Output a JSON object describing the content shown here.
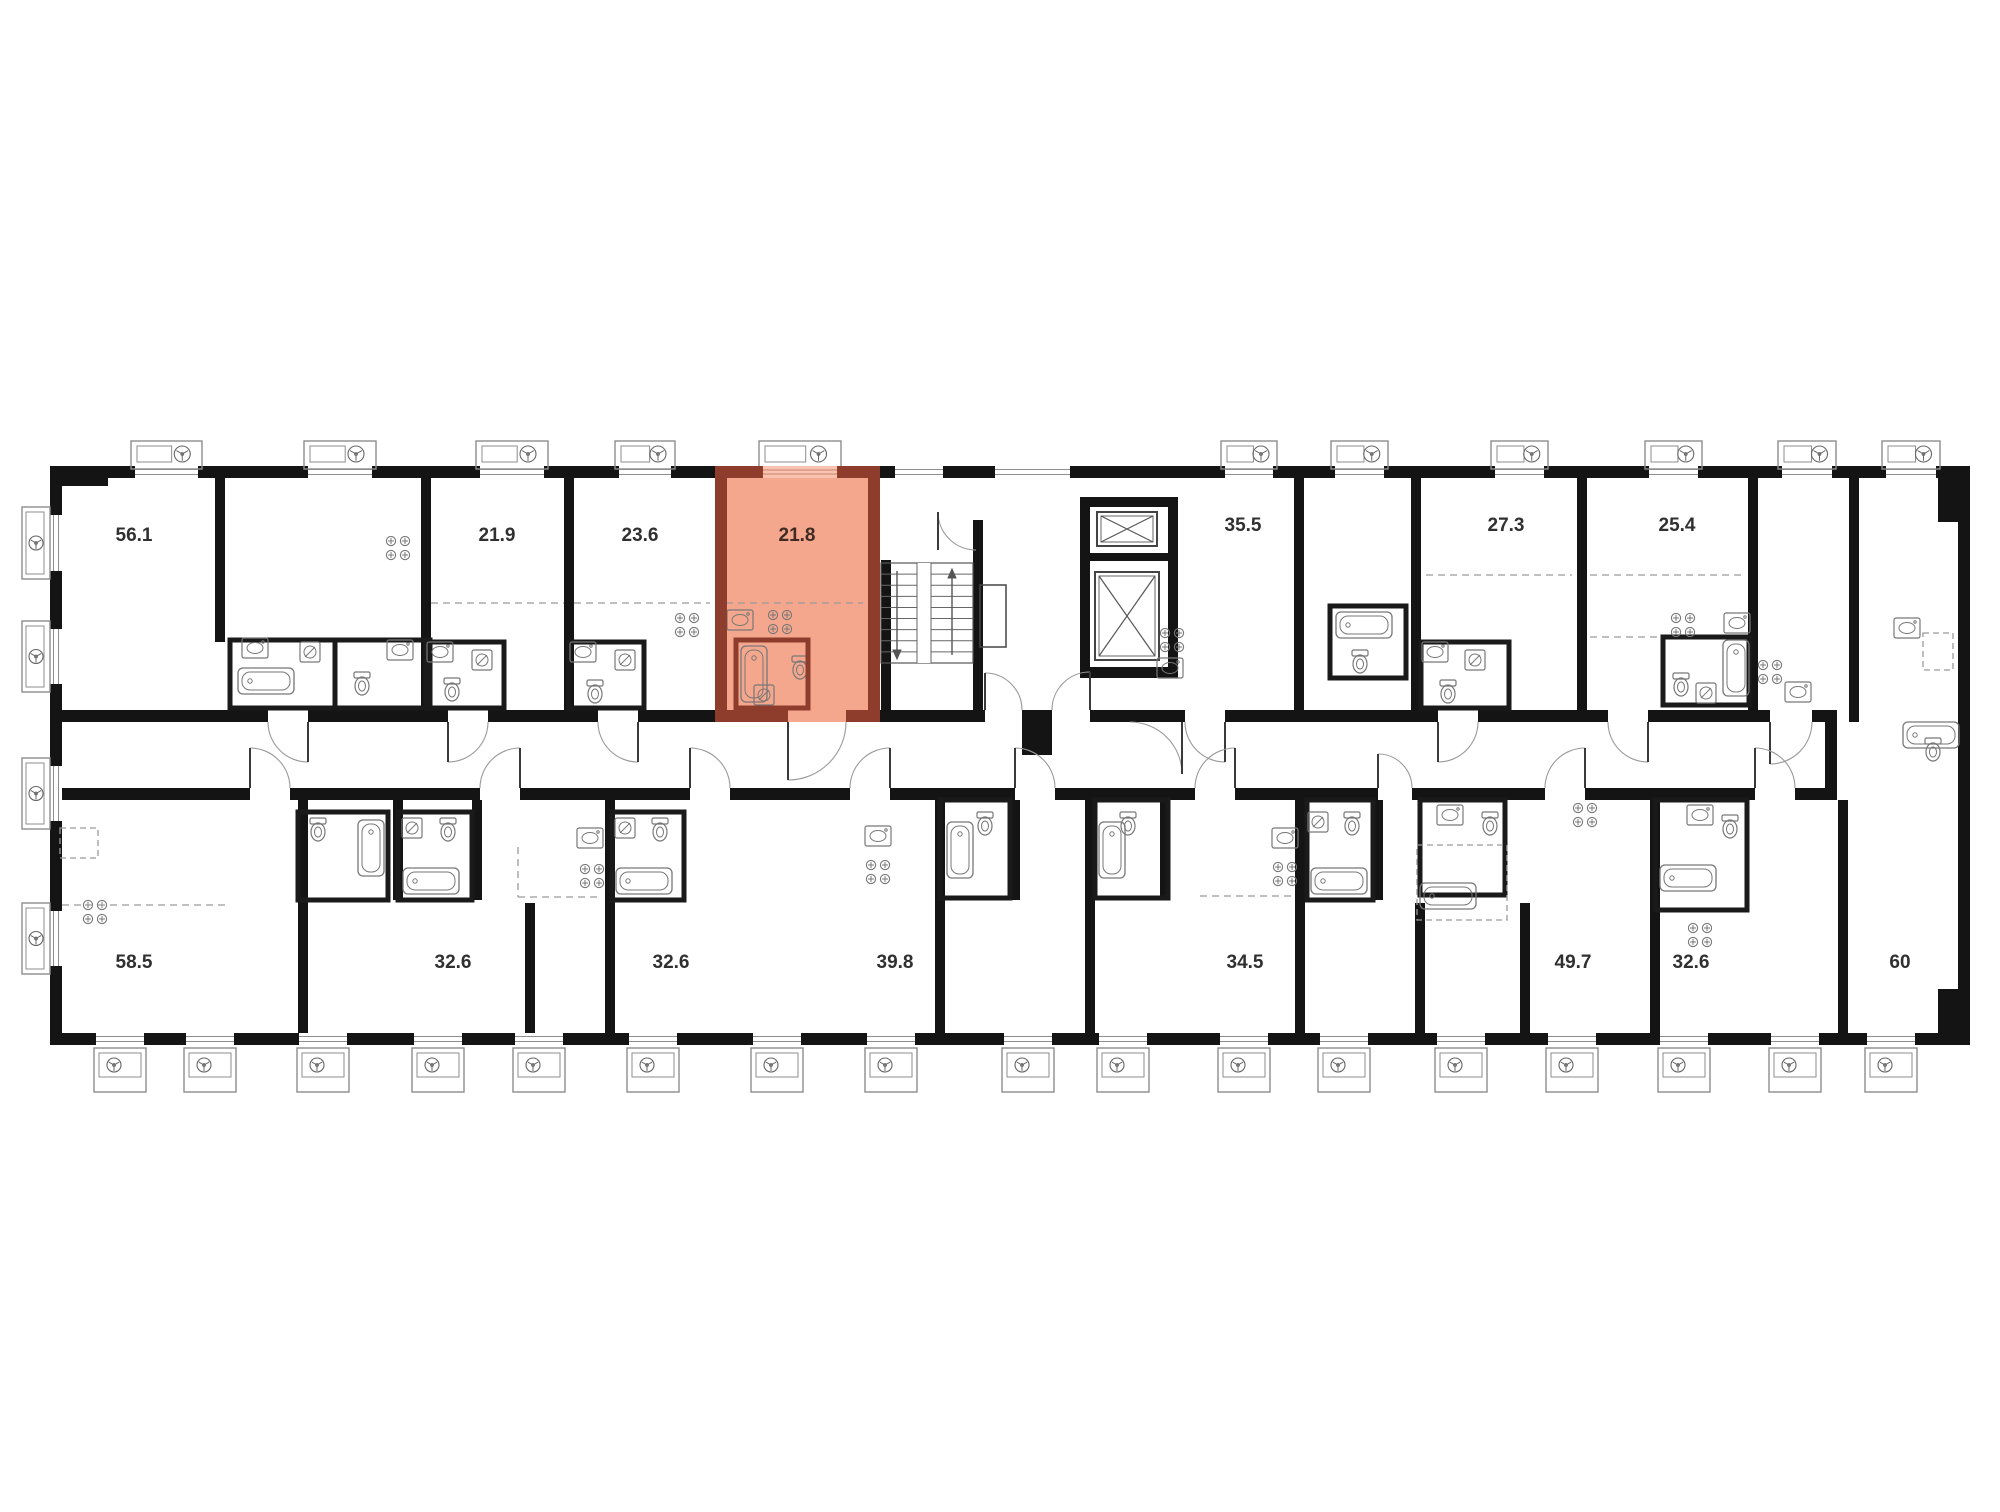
{
  "plan": {
    "type": "residential-floor-plan",
    "highlighted_unit": {
      "area": "21.8",
      "fill": "#f5a78e",
      "wall": "#8e3c2b",
      "window": "#f9c3b2"
    },
    "colors": {
      "wall": "#141414",
      "thin": "#1f1f1f",
      "fixture": "#777777",
      "dash": "#9a9a9a",
      "door_arc": "#9a9a9a",
      "door_leaf": "#3a3a3a",
      "balcony": "#8d8d8d",
      "window_line": "#8d8d8d",
      "label": "#303030",
      "highlight_label": "#3f2b23"
    },
    "labels": [
      {
        "text": "56.1",
        "x": 134,
        "y": 541
      },
      {
        "text": "21.9",
        "x": 497,
        "y": 541
      },
      {
        "text": "23.6",
        "x": 640,
        "y": 541
      },
      {
        "text": "21.8",
        "x": 797,
        "y": 541,
        "hl": true
      },
      {
        "text": "35.5",
        "x": 1243,
        "y": 531
      },
      {
        "text": "27.3",
        "x": 1506,
        "y": 531
      },
      {
        "text": "25.4",
        "x": 1677,
        "y": 531
      },
      {
        "text": "58.5",
        "x": 134,
        "y": 968
      },
      {
        "text": "32.6",
        "x": 453,
        "y": 968
      },
      {
        "text": "32.6",
        "x": 671,
        "y": 968
      },
      {
        "text": "39.8",
        "x": 895,
        "y": 968
      },
      {
        "text": "34.5",
        "x": 1245,
        "y": 968
      },
      {
        "text": "49.7",
        "x": 1573,
        "y": 968
      },
      {
        "text": "32.6",
        "x": 1691,
        "y": 968
      },
      {
        "text": "60",
        "x": 1900,
        "y": 968
      }
    ],
    "geometry": {
      "canvas": [
        2000,
        1512
      ],
      "outer": {
        "top": [
          50,
          466,
          1920,
          12
        ],
        "bottom": [
          50,
          1033,
          1920,
          12
        ],
        "left": [
          50,
          466,
          12,
          579
        ],
        "right": [
          1958,
          466,
          12,
          579
        ],
        "pillars": [
          [
            1938,
            466,
            32,
            56
          ],
          [
            1938,
            989,
            32,
            56
          ],
          [
            50,
            466,
            58,
            20
          ]
        ]
      },
      "band_top": {
        "y": 710,
        "h": 12,
        "x0": 50,
        "x1": 1825,
        "gaps": [
          [
            268,
            308
          ],
          [
            448,
            488
          ],
          [
            598,
            638
          ],
          [
            788,
            846
          ],
          [
            985,
            1022
          ],
          [
            1052,
            1090
          ],
          [
            1185,
            1225
          ],
          [
            1438,
            1478
          ],
          [
            1608,
            1648
          ],
          [
            1770,
            1812
          ]
        ]
      },
      "band_bottom": {
        "y": 788,
        "h": 12,
        "x0": 50,
        "x1": 1825,
        "gaps": [
          [
            250,
            290
          ],
          [
            480,
            520
          ],
          [
            690,
            730
          ],
          [
            850,
            890
          ],
          [
            1015,
            1055
          ],
          [
            1195,
            1235
          ],
          [
            1378,
            1412
          ],
          [
            1545,
            1585
          ],
          [
            1755,
            1795
          ]
        ]
      },
      "corridor_end_wall": [
        1825,
        710,
        12,
        90
      ],
      "lobby_post": [
        1022,
        710,
        30,
        45
      ],
      "vwalls": [
        [
          215,
          466,
          10,
          176
        ],
        [
          421,
          466,
          10,
          256
        ],
        [
          564,
          466,
          10,
          256
        ],
        [
          881,
          560,
          10,
          162
        ],
        [
          973,
          520,
          10,
          202
        ],
        [
          1294,
          466,
          10,
          256
        ],
        [
          1411,
          466,
          10,
          256
        ],
        [
          1577,
          466,
          10,
          256
        ],
        [
          1748,
          466,
          10,
          256
        ],
        [
          1849,
          466,
          10,
          256
        ],
        [
          298,
          800,
          10,
          233
        ],
        [
          605,
          800,
          10,
          233
        ],
        [
          935,
          800,
          10,
          233
        ],
        [
          1085,
          800,
          10,
          233
        ],
        [
          1295,
          800,
          10,
          233
        ],
        [
          1650,
          800,
          10,
          233
        ],
        [
          1838,
          800,
          10,
          233
        ],
        [
          393,
          800,
          10,
          100
        ],
        [
          472,
          800,
          10,
          100
        ],
        [
          1010,
          800,
          10,
          100
        ],
        [
          1160,
          800,
          10,
          100
        ],
        [
          1373,
          800,
          10,
          100
        ],
        [
          525,
          903,
          10,
          130
        ],
        [
          1415,
          903,
          10,
          130
        ],
        [
          1520,
          903,
          10,
          130
        ]
      ],
      "balconies_top": [
        [
          135,
          63
        ],
        [
          308,
          64
        ],
        [
          480,
          64
        ],
        [
          619,
          52
        ],
        [
          763,
          74
        ],
        [
          1225,
          48
        ],
        [
          1335,
          49
        ],
        [
          1495,
          49
        ],
        [
          1649,
          49
        ],
        [
          1782,
          50
        ],
        [
          1886,
          50
        ]
      ],
      "windows_top_extra": [
        [
          895,
          48
        ],
        [
          995,
          75
        ]
      ],
      "balconies_bottom_cx": [
        120,
        210,
        323,
        438,
        539,
        653,
        777,
        891,
        1028,
        1123,
        1244,
        1344,
        1461,
        1572,
        1684,
        1795,
        1891
      ],
      "balconies_left": [
        [
          507,
          72
        ],
        [
          621,
          71
        ],
        [
          758,
          71
        ],
        [
          903,
          71
        ]
      ],
      "stairs": {
        "x": 881,
        "y": 563,
        "w": 92,
        "h": 100,
        "treads": 9,
        "gap": [
          917,
          931
        ],
        "duct": [
          980,
          585,
          26,
          62
        ]
      },
      "elevators": {
        "frame": [
          [
            1080,
            497,
            10,
            180
          ],
          [
            1168,
            497,
            10,
            180
          ],
          [
            1080,
            497,
            98,
            10
          ],
          [
            1080,
            667,
            98,
            11
          ],
          [
            1080,
            553,
            98,
            8
          ]
        ],
        "cabs": [
          [
            1097,
            512,
            60,
            34
          ],
          [
            1095,
            572,
            64,
            88
          ]
        ]
      },
      "red_unit": {
        "x": 715,
        "x2": 880,
        "y": 466,
        "y2": 722,
        "t": 12,
        "window": [
          763,
          74
        ],
        "door": [
          788,
          846
        ],
        "bath": [
          736,
          640,
          72,
          68
        ]
      },
      "bath_blocks": [
        [
          230,
          640,
          105,
          68
        ],
        [
          335,
          640,
          95,
          68
        ],
        [
          426,
          642,
          78,
          66
        ],
        [
          569,
          642,
          75,
          66
        ],
        [
          1330,
          606,
          76,
          72
        ],
        [
          1421,
          642,
          88,
          66
        ],
        [
          1663,
          637,
          86,
          68
        ],
        [
          298,
          812,
          90,
          88
        ],
        [
          398,
          812,
          74,
          88
        ],
        [
          612,
          812,
          72,
          88
        ],
        [
          940,
          800,
          70,
          98
        ],
        [
          1095,
          800,
          73,
          98
        ],
        [
          1307,
          800,
          66,
          100
        ],
        [
          1420,
          800,
          85,
          95
        ],
        [
          1655,
          800,
          92,
          110
        ]
      ],
      "doors_top": [
        [
          268,
          308,
          "dnR"
        ],
        [
          448,
          488,
          "dnL"
        ],
        [
          598,
          638,
          "dnR"
        ],
        [
          788,
          846,
          "dnL"
        ],
        [
          985,
          1022,
          "upL"
        ],
        [
          1052,
          1090,
          "upR"
        ],
        [
          1185,
          1225,
          "dnR"
        ],
        [
          1438,
          1478,
          "dnL"
        ],
        [
          1608,
          1648,
          "dnR"
        ],
        [
          1770,
          1812,
          "dnL"
        ]
      ],
      "doors_bottom": [
        [
          250,
          290,
          "uL"
        ],
        [
          480,
          520,
          "uR"
        ],
        [
          690,
          730,
          "uL"
        ],
        [
          850,
          890,
          "uR"
        ],
        [
          1015,
          1055,
          "uL"
        ],
        [
          1195,
          1235,
          "uR"
        ],
        [
          1378,
          1412,
          "uL"
        ],
        [
          1545,
          1585,
          "uR"
        ],
        [
          1755,
          1795,
          "uL"
        ]
      ],
      "extra_arcs": [
        {
          "d": "M 938 512 A 38 38 0 0 0 976 550",
          "leaf": [
            938,
            512,
            938,
            550
          ]
        },
        {
          "d": "M 1130 722 A 52 52 0 0 1 1182 774",
          "leaf": [
            1182,
            722,
            1182,
            774
          ]
        }
      ],
      "stoves": [
        [
          398,
          548
        ],
        [
          687,
          625
        ],
        [
          780,
          622
        ],
        [
          1172,
          640
        ],
        [
          1683,
          625
        ],
        [
          1770,
          672
        ],
        [
          95,
          912
        ],
        [
          592,
          876
        ],
        [
          878,
          872
        ],
        [
          1285,
          874
        ],
        [
          1585,
          815
        ],
        [
          1700,
          935
        ]
      ],
      "sinks": [
        [
          255,
          648
        ],
        [
          400,
          650
        ],
        [
          440,
          652
        ],
        [
          583,
          652
        ],
        [
          740,
          620
        ],
        [
          1170,
          668
        ],
        [
          1435,
          652
        ],
        [
          1737,
          623
        ],
        [
          1798,
          692
        ],
        [
          1907,
          628
        ],
        [
          590,
          838
        ],
        [
          878,
          836
        ],
        [
          1285,
          838
        ],
        [
          1450,
          815
        ],
        [
          1700,
          815
        ]
      ],
      "toilets": [
        [
          362,
          682
        ],
        [
          452,
          688
        ],
        [
          595,
          690
        ],
        [
          800,
          666
        ],
        [
          1360,
          660
        ],
        [
          1448,
          690
        ],
        [
          1681,
          683
        ],
        [
          1933,
          748
        ],
        [
          318,
          828
        ],
        [
          448,
          828
        ],
        [
          660,
          828
        ],
        [
          985,
          822
        ],
        [
          1128,
          822
        ],
        [
          1352,
          822
        ],
        [
          1490,
          822
        ],
        [
          1730,
          825
        ]
      ],
      "washers": [
        [
          310,
          652
        ],
        [
          482,
          660
        ],
        [
          625,
          660
        ],
        [
          764,
          695
        ],
        [
          1475,
          660
        ],
        [
          1706,
          693
        ],
        [
          412,
          828
        ],
        [
          625,
          828
        ],
        [
          1318,
          822
        ]
      ],
      "tubs_h": [
        [
          238,
          668
        ],
        [
          1336,
          612
        ],
        [
          1903,
          722
        ],
        [
          403,
          868
        ],
        [
          616,
          868
        ],
        [
          1311,
          868
        ],
        [
          1660,
          865
        ],
        [
          1420,
          883
        ]
      ],
      "tubs_v": [
        [
          741,
          646
        ],
        [
          1723,
          640
        ],
        [
          358,
          820
        ],
        [
          947,
          822
        ],
        [
          1099,
          822
        ]
      ],
      "dash_lines": [
        [
          431,
          603,
          564,
          603
        ],
        [
          574,
          603,
          710,
          603
        ],
        [
          726,
          603,
          863,
          603
        ],
        [
          1426,
          575,
          1572,
          575
        ],
        [
          1590,
          575,
          1743,
          575
        ],
        [
          1590,
          637,
          1658,
          637
        ],
        [
          62,
          905,
          225,
          905
        ],
        [
          1200,
          896,
          1293,
          896
        ],
        [
          518,
          847,
          518,
          897
        ],
        [
          518,
          897,
          602,
          897
        ]
      ],
      "dash_rects": [
        [
          60,
          828,
          38,
          30
        ],
        [
          1923,
          633,
          30,
          37
        ],
        [
          1417,
          845,
          90,
          75
        ]
      ]
    }
  }
}
